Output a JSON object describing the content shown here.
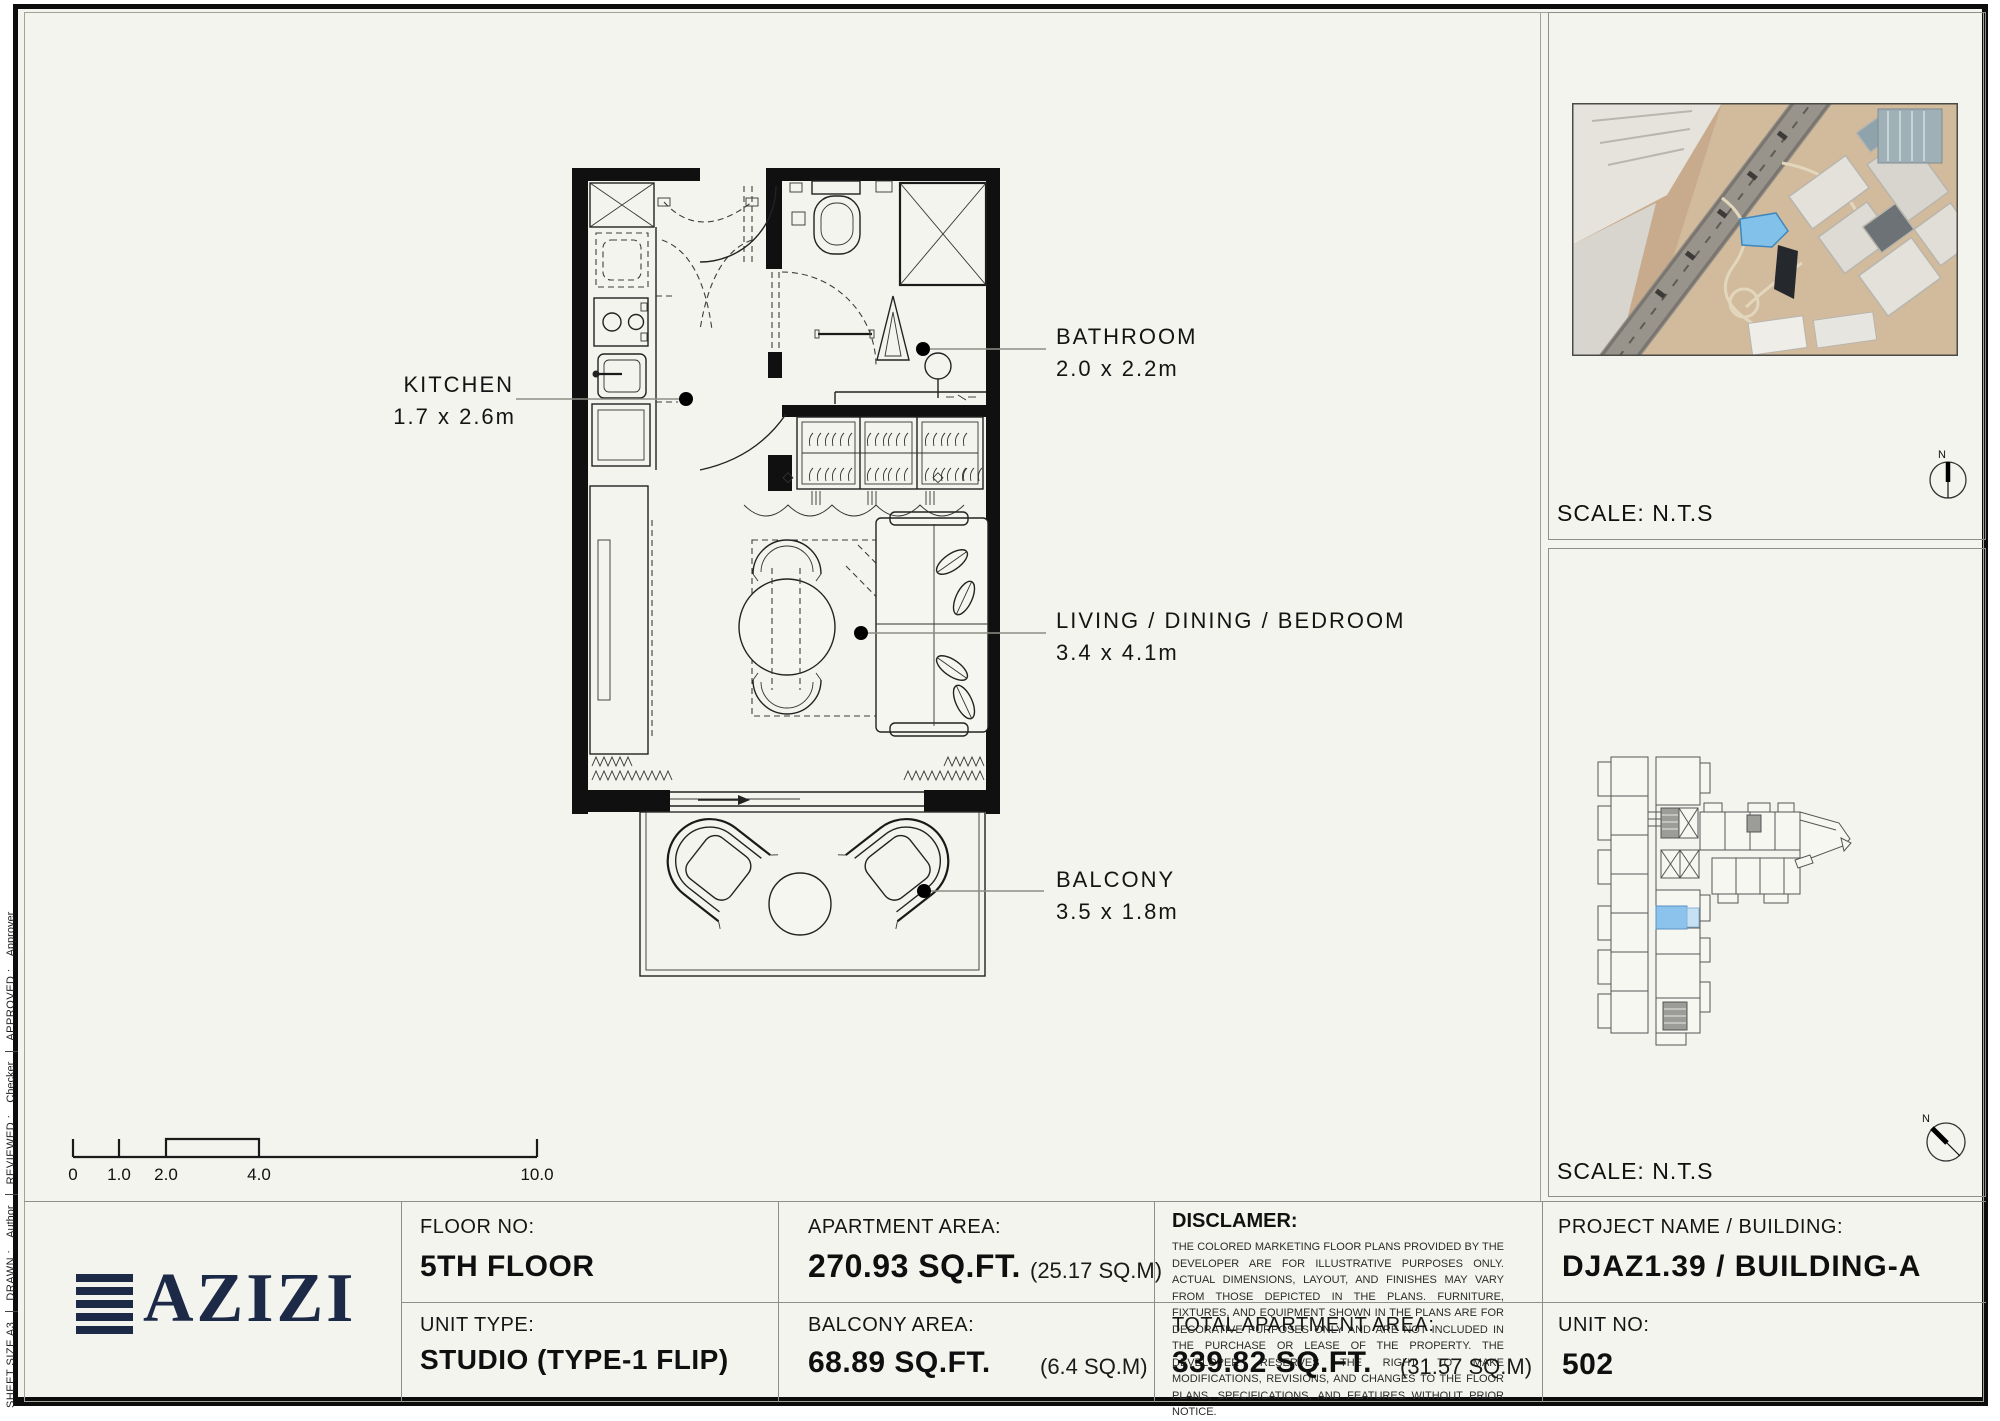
{
  "colors": {
    "sheet_bg": "#f4f4ee",
    "logo_navy": "#1d2a47",
    "highlight_blue": "#8cc3ec",
    "wall_black": "#101010"
  },
  "side_strip": {
    "sheet_size": "SHEET SIZE A3",
    "drawn_label": "DRAWN :",
    "drawn_value": "Author",
    "reviewed_label": "REVIEWED :",
    "reviewed_value": "Checker",
    "approved_label": "APPROVED :",
    "approved_value": "Approver"
  },
  "plan": {
    "rooms": [
      {
        "name": "KITCHEN",
        "dims": "1.7 x 2.6m"
      },
      {
        "name": "BATHROOM",
        "dims": "2.0 x 2.2m"
      },
      {
        "name": "LIVING / DINING / BEDROOM",
        "dims": "3.4 x 4.1m"
      },
      {
        "name": "BALCONY",
        "dims": "3.5 x 1.8m"
      }
    ],
    "scale_bar": {
      "labels": [
        "0",
        "1.0",
        "2.0",
        "4.0",
        "10.0"
      ]
    }
  },
  "map_panel": {
    "scale_label": "SCALE: N.T.S",
    "compass_n": "N"
  },
  "keyplan_panel": {
    "scale_label": "SCALE: N.T.S",
    "compass_n": "N"
  },
  "titleblock": {
    "logo_text": "AZIZI",
    "floor": {
      "label": "FLOOR NO:",
      "value": "5TH FLOOR"
    },
    "unit_type": {
      "label": "UNIT TYPE:",
      "value": "STUDIO (TYPE-1 FLIP)"
    },
    "apartment_area": {
      "label": "APARTMENT AREA:",
      "value": "270.93 SQ.FT.",
      "metric": "(25.17 SQ.M)"
    },
    "balcony_area": {
      "label": "BALCONY AREA:",
      "value": "68.89 SQ.FT.",
      "metric": "(6.4 SQ.M)"
    },
    "disclaimer": {
      "label": "DISCLAMER:",
      "body": "THE COLORED MARKETING FLOOR PLANS PROVIDED BY THE DEVELOPER ARE FOR ILLUSTRATIVE PURPOSES ONLY. ACTUAL DIMENSIONS, LAYOUT, AND FINISHES MAY VARY FROM THOSE DEPICTED IN THE PLANS. FURNITURE, FIXTURES, AND EQUIPMENT SHOWN IN THE PLANS ARE FOR DECORATIVE PURPOSES ONLY AND ARE NOT INCLUDED IN THE PURCHASE OR LEASE OF THE PROPERTY. THE DEVELOPER RESERVES THE RIGHT TO MAKE MODIFICATIONS, REVISIONS, AND CHANGES TO THE FLOOR PLANS, SPECIFICATIONS, AND FEATURES WITHOUT PRIOR NOTICE."
    },
    "total_area": {
      "label": "TOTAL APARTMENT AREA:",
      "value": "339.82 SQ.FT.",
      "metric": "(31.57 SQ.M)"
    },
    "project": {
      "label": "PROJECT NAME / BUILDING:",
      "value": "DJAZ1.39 / BUILDING-A"
    },
    "unit_no": {
      "label": "UNIT NO:",
      "value": "502"
    }
  }
}
